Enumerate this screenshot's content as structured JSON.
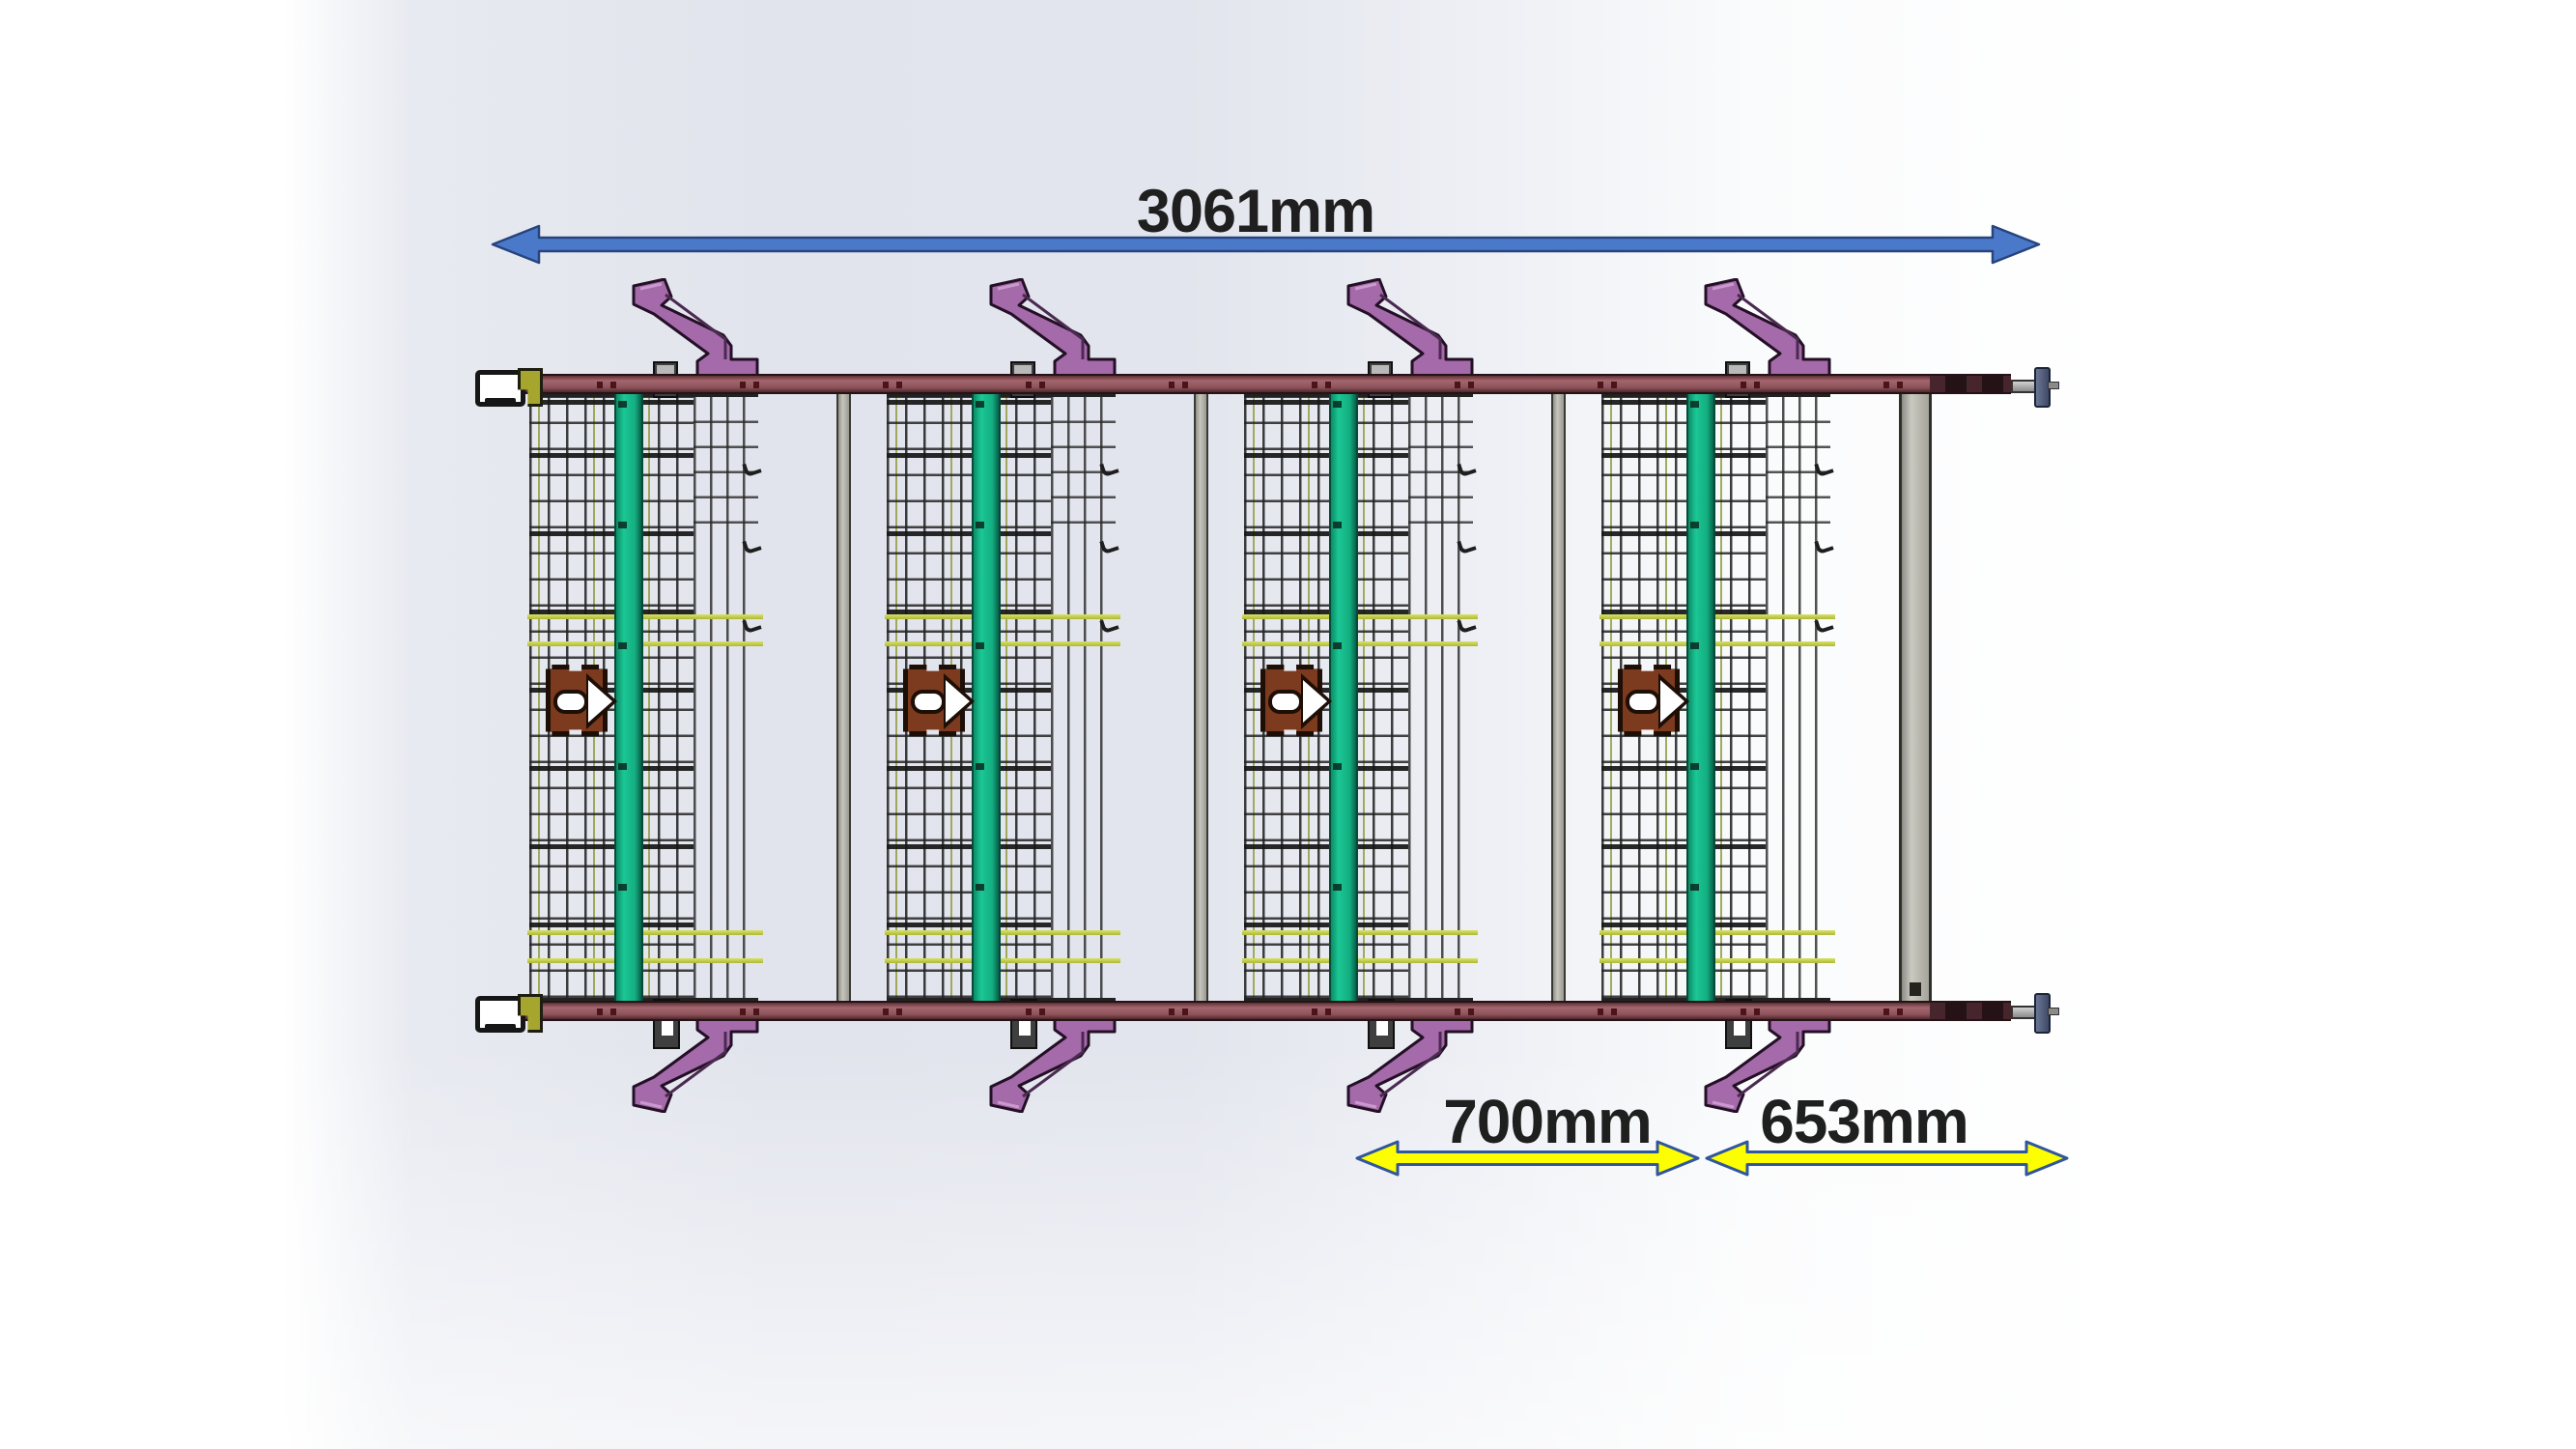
{
  "annotations": {
    "overall_width": "3061mm",
    "module_pitch": "700mm",
    "end_section": "653mm"
  },
  "machine": {
    "module_count": 4,
    "separator_count": 3,
    "handle_count_top": 4,
    "handle_count_bottom": 4
  },
  "colors": {
    "dimension_arrow_overall_fill": "#4b79c9",
    "dimension_arrow_overall_outline": "#27447e",
    "dimension_arrow_segment_fill": "#fdff00",
    "dimension_arrow_segment_outline": "#30569c",
    "label_text": "#1f1f1f",
    "rail_maroon": "#8c525a",
    "handle_purple": "#a56aa9",
    "belt_stripe_green": "#13ad80",
    "mesh_wire_dark": "#2a2a2a",
    "mesh_accent_olive": "#949e42",
    "crossbar_yellow": "#c9d34f",
    "bracket_brown": "#7c3a1e",
    "separator_gray": "#b3b3ab",
    "end_flange_blue": "#4e5c80",
    "end_block_olive": "#a6a62e",
    "background_tint": "#e3e5ee"
  }
}
